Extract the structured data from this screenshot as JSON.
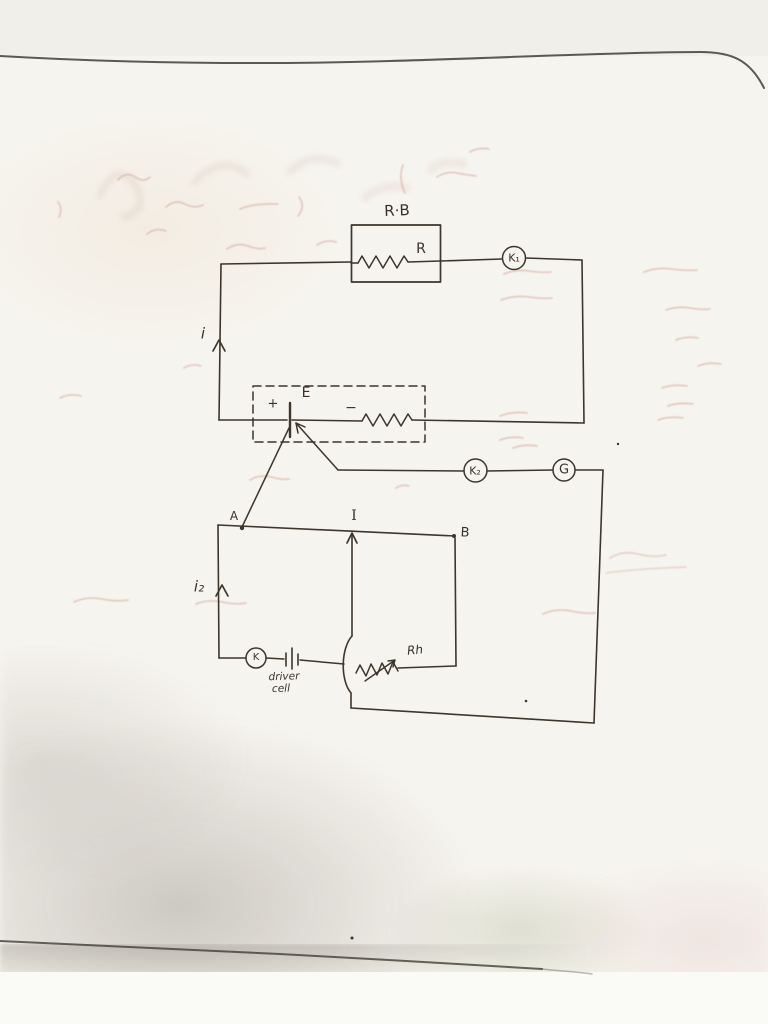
{
  "diagram": {
    "primary_loop": {
      "resistance_box_title": "R·B",
      "resistor_label": "R",
      "key1_label": "K₁",
      "current_label": "i"
    },
    "cell_enclosure": {
      "plus_label": "+",
      "emf_label": "E",
      "minus_label": "−"
    },
    "galvanometer_branch": {
      "key2_label": "K₂",
      "galvanometer_label": "G"
    },
    "potentiometer_loop": {
      "end_a_label": "A",
      "jockey_label": "I",
      "end_b_label": "B",
      "current_label": "i₂",
      "key_label": "K",
      "driver_cell_label": [
        "driver",
        "cell"
      ],
      "rheostat_label": "Rh"
    }
  }
}
